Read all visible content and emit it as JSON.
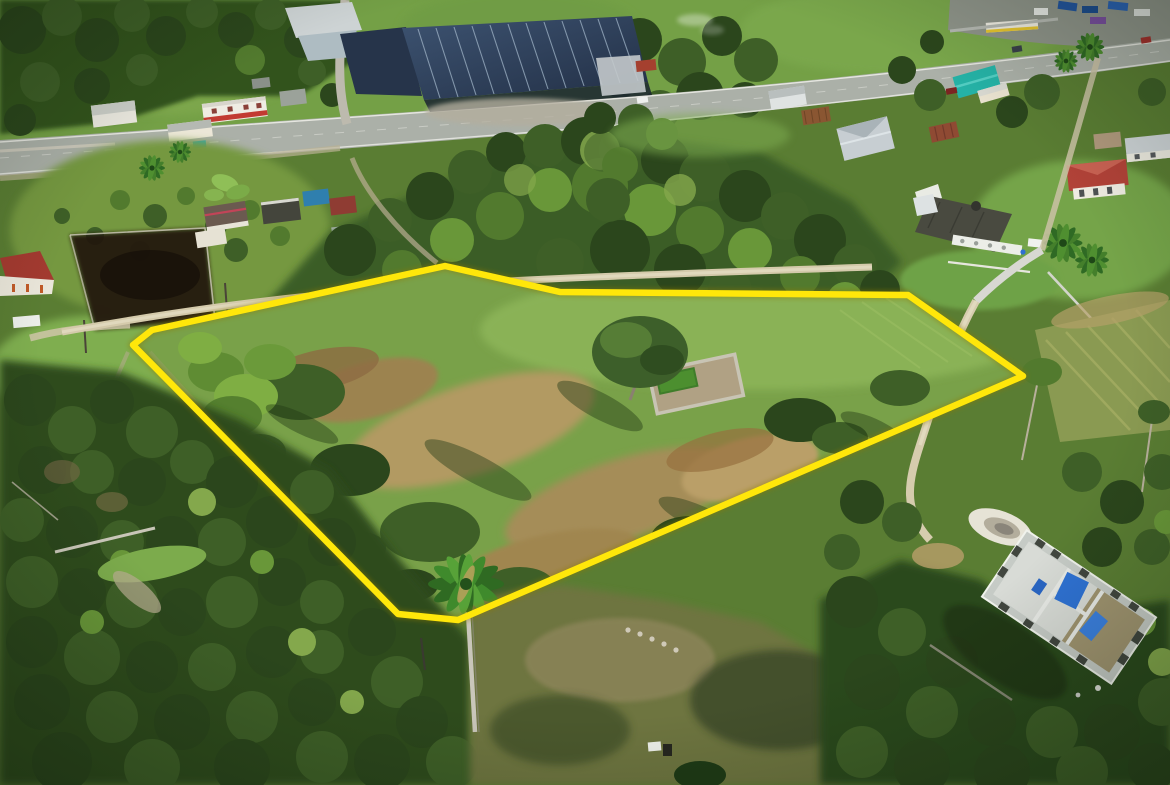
{
  "image": {
    "kind": "aerial-drone-photograph",
    "subject": "Vacant overgrown land parcel marked with a yellow property-boundary overlay",
    "setting": "Tropical village beside a paved highway, bright daylight, shadows to lower-left",
    "overlay": {
      "boundary_color": "#ffe70a",
      "boundary_glow": "#8f7a00",
      "boundary_stroke_width": "6.5",
      "boundary_points": "133,345 152,330 445,266 560,292 908,295 1023,376 458,620 398,614"
    },
    "palette": {
      "canopy_dark": "#2b461c",
      "canopy_mid": "#3e5f27",
      "canopy_bright": "#699739",
      "sunlit_leaf": "#84a84c",
      "parcel_grass": "#79a149",
      "dry_grass": "#b29a62",
      "asphalt": "#abb0a8",
      "dirt_road": "#d4caab",
      "solar_roof": "#2b3c55",
      "red_roof": "#a33a30",
      "teal_roof": "#25b2a6",
      "concrete_walls": "#c6cbc6",
      "tarp_blue": "#2f72d4",
      "burned_ground": "#231810"
    },
    "landmarks": {
      "highway": "paved road crossing the upper area from left edge to top right",
      "solar_warehouse": "large industrial building with rooftop solar panels, top center",
      "truck_yard": "trucks and containers in the top-right corner",
      "village_houses": "small houses along both sides of the highway",
      "burned_plot": "scorched dark field on the left side",
      "left_red_roof_house": "red hip-roof house with white van, left edge",
      "two_story_house": "white two-story house with red hip roof, right side",
      "walled_garden": "stone-walled garden plot with big tree inside the parcel",
      "royal_palm": "tall royal palm on the lower boundary of the parcel",
      "unfinished_building": "roofless concrete-block structure with blue tarps, lower right",
      "parcel": "grassy scrub parcel enclosed by the yellow boundary"
    }
  }
}
